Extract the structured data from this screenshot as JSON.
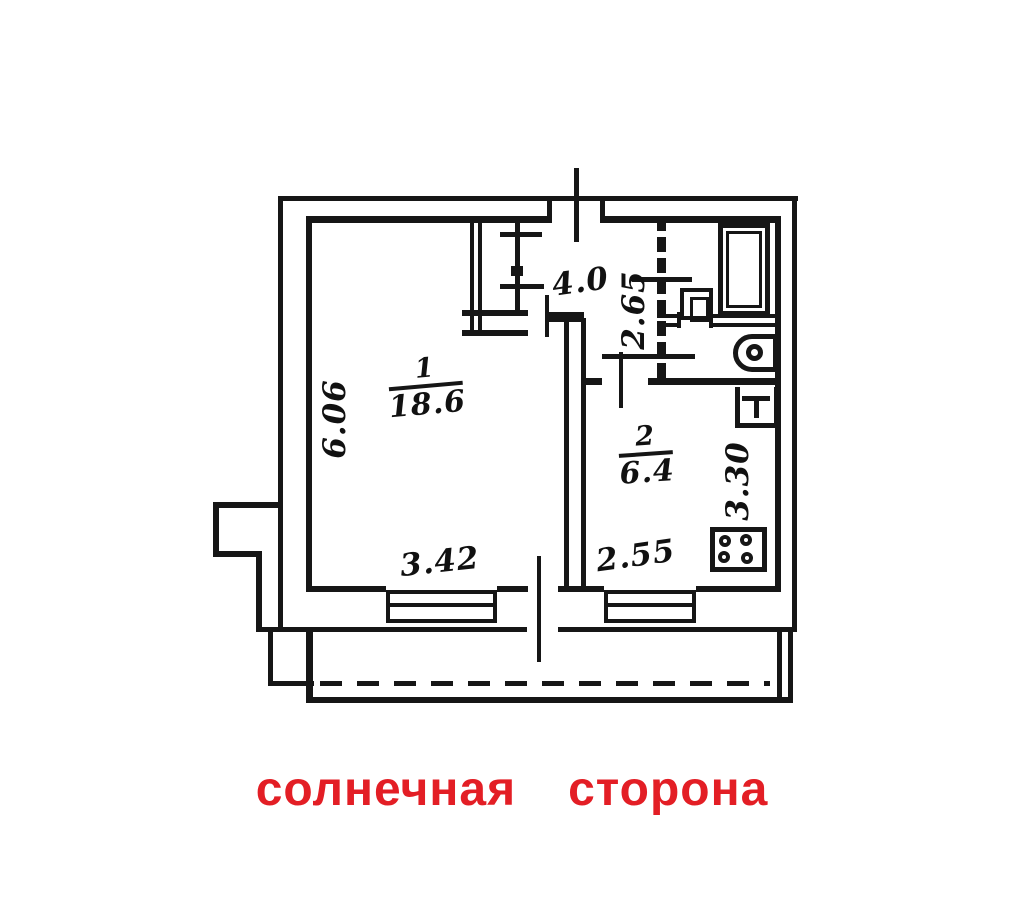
{
  "plan": {
    "caption": {
      "word1": "солнечная",
      "word2": "сторона",
      "color": "#e31e25"
    },
    "room1": {
      "number": "1",
      "area": "18.6"
    },
    "room2": {
      "number": "2",
      "area": "6.4"
    },
    "dims": {
      "hall_width": "4.0",
      "hall_depth": "2.65",
      "left_depth": "6.06",
      "room1_window": "3.42",
      "kitchen_window": "2.55",
      "kitchen_depth": "3.30"
    },
    "fixtures": [
      "bathtub",
      "wash-basin",
      "toilet",
      "kitchen-sink",
      "stove"
    ],
    "line_color": "#161616"
  }
}
